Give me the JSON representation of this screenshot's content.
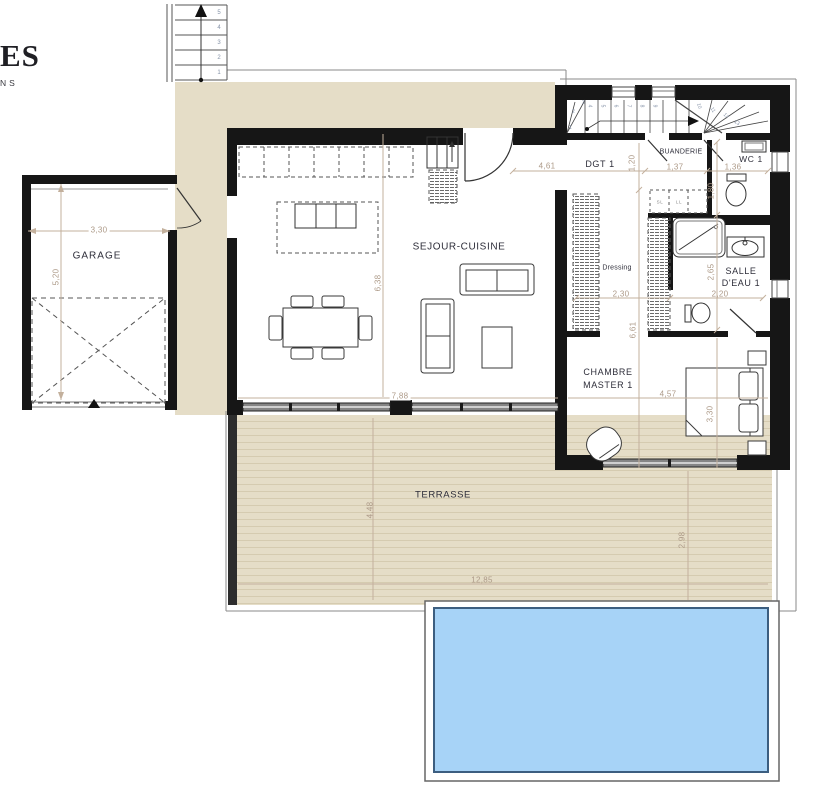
{
  "logo": {
    "line1": "ES",
    "line2": "NS"
  },
  "rooms": {
    "garage": "GARAGE",
    "sejour": "SEJOUR-CUISINE",
    "terrasse": "TERRASSE",
    "dgt": "DGT 1",
    "buanderie": "BUANDERIE",
    "wc": "WC 1",
    "dressing": "Dressing",
    "salle_eau_l1": "SALLE",
    "salle_eau_l2": "D'EAU 1",
    "chambre_l1": "CHAMBRE",
    "chambre_l2": "MASTER 1",
    "closet_sl": "SL",
    "closet_ll": "LL"
  },
  "dimensions": {
    "garage_width": "3,30",
    "garage_depth": "5,20",
    "sejour_width": "7,88",
    "sejour_depth": "6,38",
    "entry_width": "4,61",
    "buanderie_width": "1,37",
    "wc_width": "1,36",
    "dgt_depth": "1,20",
    "wc_depth": "1,80",
    "dressing_width": "2,30",
    "salle_eau_width": "2,20",
    "salle_eau_depth": "2,65",
    "east_wing_depth": "6,61",
    "chambre_width": "4,57",
    "chambre_depth": "3,30",
    "terrasse_depth": "4,48",
    "terrasse_width": "12,85",
    "terrasse_right_depth": "2,98"
  },
  "stairs": {
    "exterior": [
      "5",
      "4",
      "3",
      "2",
      "1"
    ],
    "interior": [
      "1",
      "2",
      "3",
      "4",
      "5",
      "6",
      "7",
      "8",
      "9",
      "10",
      "11",
      "12",
      "13"
    ]
  },
  "colors": {
    "wall": "#161616",
    "beige": "#E5DDC7",
    "deck_stripe": "#D5CBB0",
    "pool_water": "#A7D3F7",
    "pool_edge": "#3C5E80",
    "dimension_text": "#AD9A88",
    "room_label": "#2E2E3A",
    "stair_number": "#8693A8"
  }
}
